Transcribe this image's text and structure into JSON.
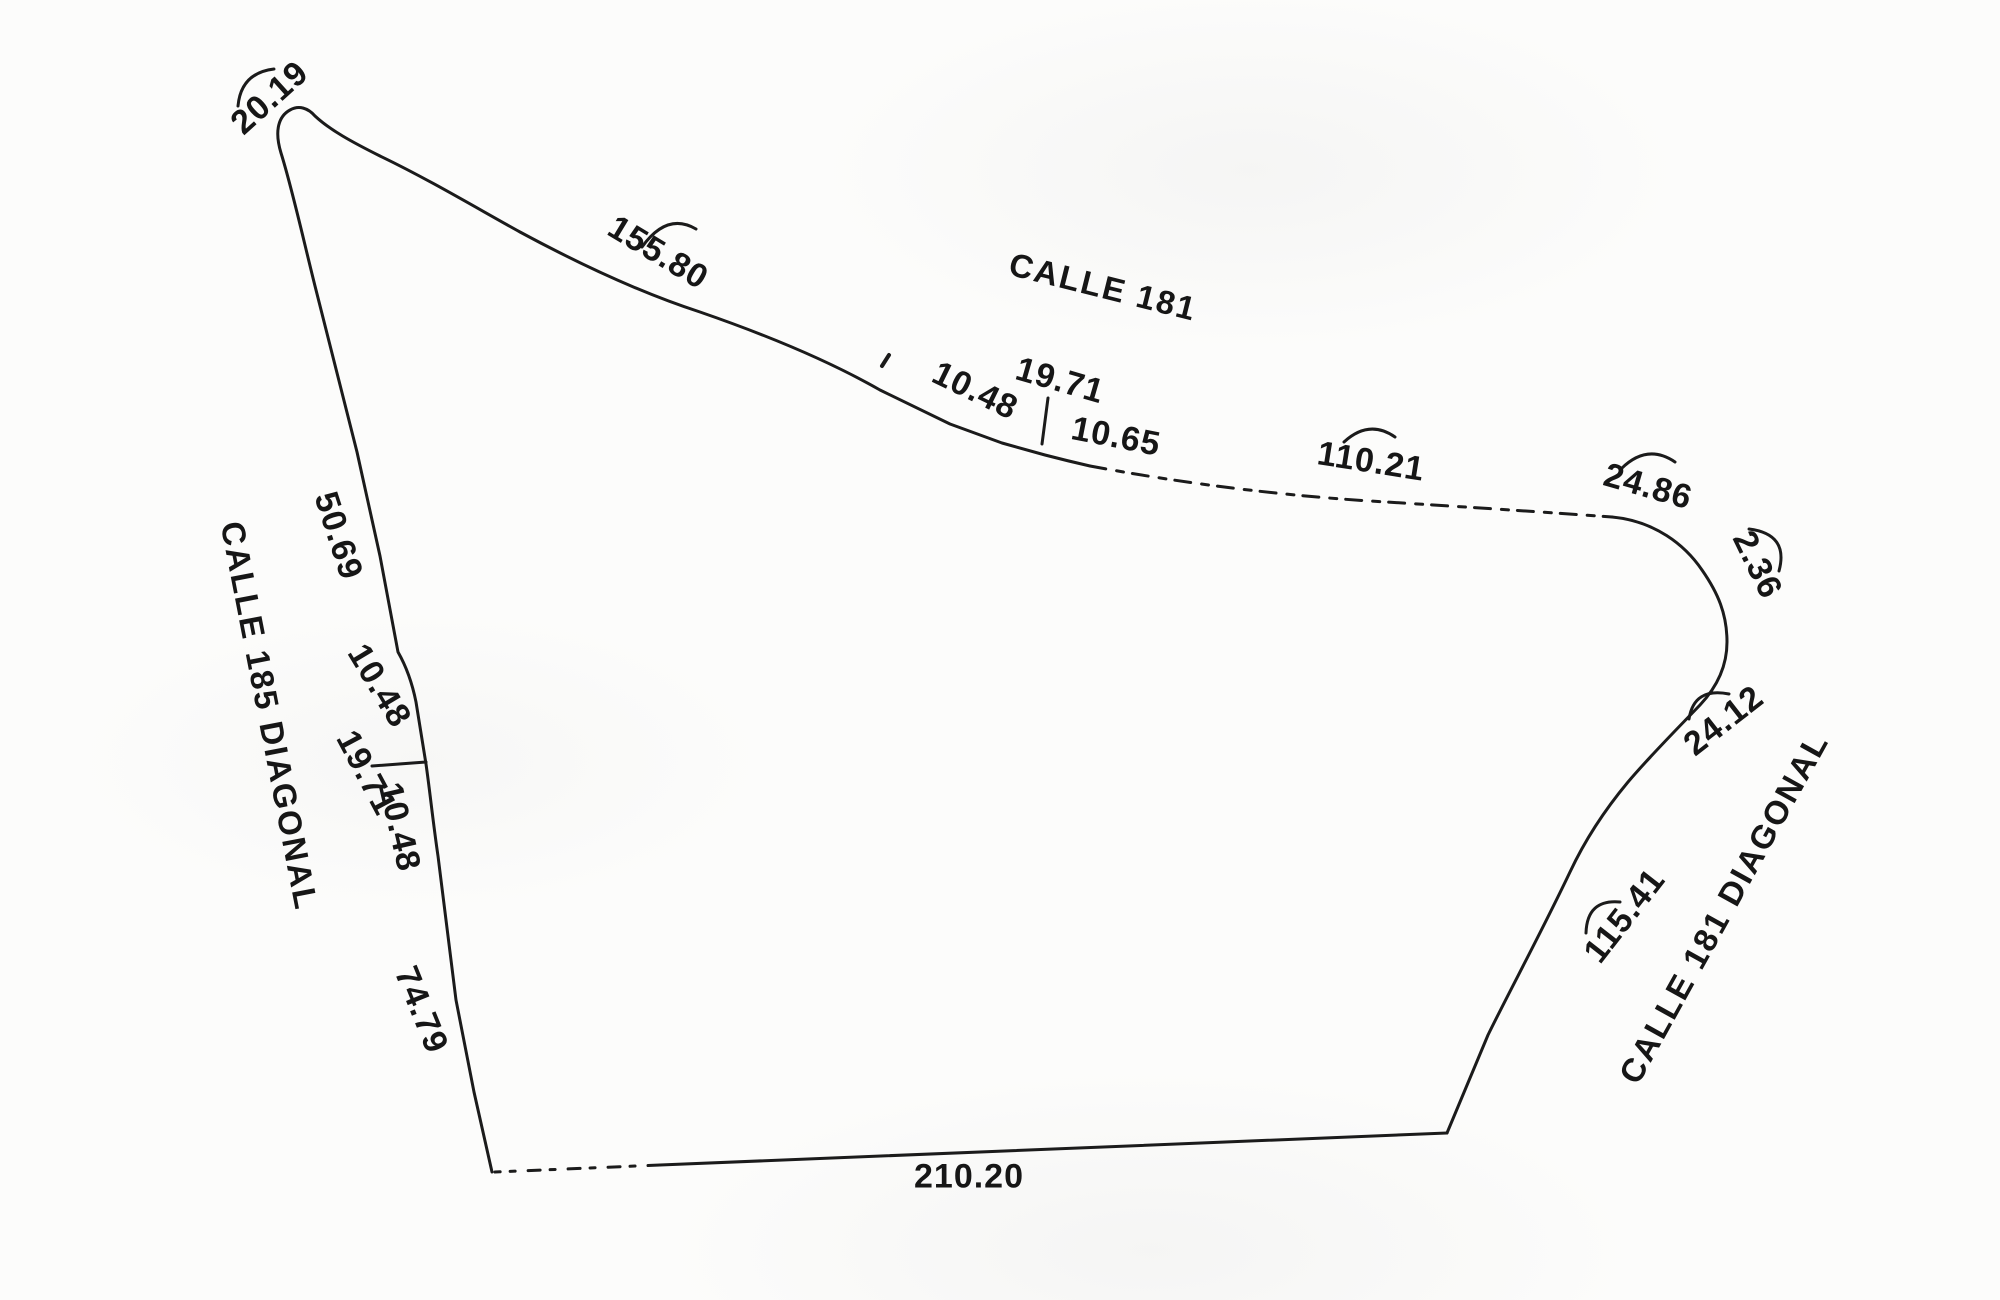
{
  "document": {
    "kind": "scanned land survey sketch",
    "ink_color": "#1b1b1b",
    "paper_color": "#fcfcfb"
  },
  "parcel": {
    "streets": [
      {
        "id": "calle-181",
        "name": "CALLE 181",
        "side": "north"
      },
      {
        "id": "calle-181-diagonal",
        "name": "CALLE 181 DIAGONAL",
        "side": "east"
      },
      {
        "id": "calle-185-diagonal",
        "name": "CALLE 185 DIAGONAL",
        "side": "west"
      }
    ],
    "boundary_segments": [
      {
        "side": "north-west corner curve",
        "length": "20.19"
      },
      {
        "side": "north",
        "street": "CALLE 181",
        "lengths": [
          "155.80",
          "10.48",
          "19.71",
          "10.65",
          "110.21",
          "24.86"
        ]
      },
      {
        "side": "east",
        "street": "CALLE 181 DIAGONAL",
        "lengths": [
          "2.36",
          "24.12",
          "115.41"
        ]
      },
      {
        "side": "south",
        "lengths": [
          "210.20"
        ]
      },
      {
        "side": "west",
        "street": "CALLE 185 DIAGONAL",
        "lengths": [
          "50.69",
          "10.48",
          "19.71",
          "10.48",
          "74.79"
        ]
      }
    ]
  },
  "labels": {
    "m20_19": "20.19",
    "m155_80": "155.80",
    "calle_181": "CALLE 181",
    "m10_48_top": "10.48",
    "m19_71_top": "19.71",
    "m10_65": "10.65",
    "m110_21": "110.21",
    "m24_86": "24.86",
    "m2_36": "2.36",
    "m24_12": "24.12",
    "m115_41": "115.41",
    "calle_181_diagonal": "CALLE 181 DIAGONAL",
    "m50_69": "50.69",
    "calle_185_diagonal": "CALLE 185 DIAGONAL",
    "m10_48_left_upper": "10.48",
    "m19_71_left": "19.71",
    "m10_48_left_lower": "10.48",
    "m74_79": "74.79",
    "m210_20": "210.20"
  }
}
